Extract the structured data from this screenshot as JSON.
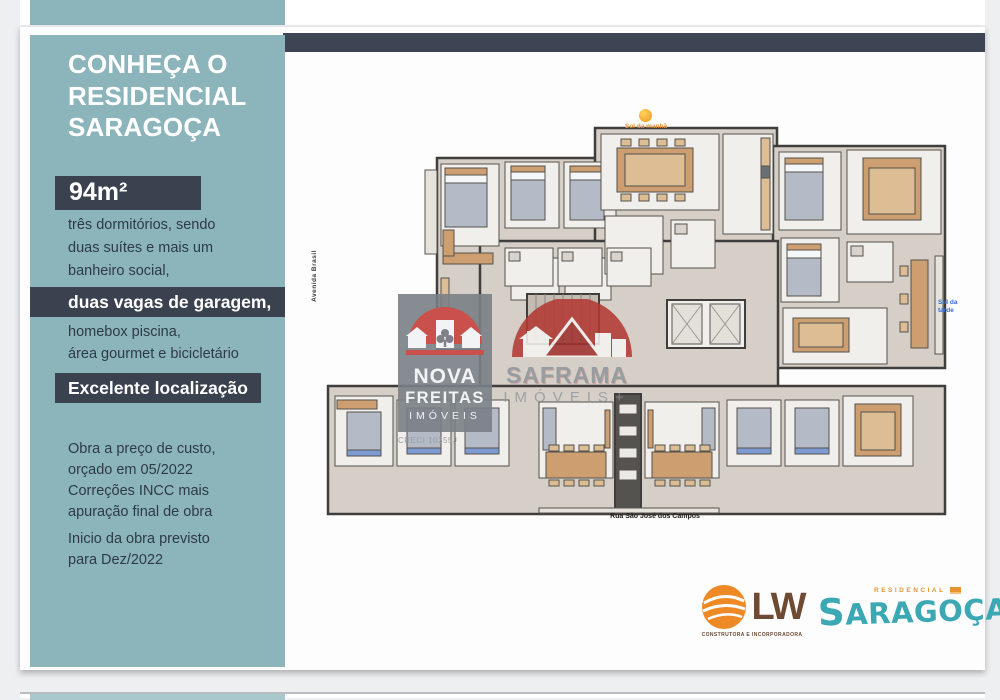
{
  "sidebar": {
    "title_lines": [
      "CONHEÇA O",
      "RESIDENCIAL",
      "SARAGOÇA"
    ],
    "area_badge": "94m²",
    "features_1": [
      "três dormitórios, sendo",
      "duas suítes e mais um",
      "banheiro social,"
    ],
    "highlight_1": "duas vagas de garagem,",
    "features_2": [
      "homebox piscina,",
      "área gourmet e bicicletário"
    ],
    "highlight_2": "Excelente localização",
    "paragraph_1": [
      "Obra a preço de custo,",
      "orçado em 05/2022",
      "Correções INCC mais",
      "apuração final de obra"
    ],
    "paragraph_2": [
      "Inicio da obra previsto",
      "para Dez/2022"
    ]
  },
  "floorplan": {
    "sun_label": "Sol da manhã",
    "afternoon_sun_label": "Sol da tarde",
    "street_left": "Avenida Brasil",
    "street_bottom": "Rua São José dos Campos"
  },
  "watermarks": {
    "nova_freitas": {
      "line1": "NOVA",
      "line2": "FREITAS",
      "line3": "IMÓVEIS",
      "creci": "CRECI 10355J"
    },
    "saframa": {
      "name": "SAFRAMA",
      "subtitle": "IMÓVEIS",
      "plus": "+"
    }
  },
  "logos": {
    "lw": {
      "name": "LW",
      "subtitle": "CONSTRUTORA E INCORPORADORA"
    },
    "saragoca": {
      "kicker": "RESIDENCIAL",
      "name": "SARAGOÇA"
    }
  },
  "colors": {
    "teal_panel": "#8cb5bb",
    "navy": "#3a4250",
    "lw_orange": "#ee8a25",
    "saragoca_teal": "#3ba8b4",
    "logo_red": "#c9504b"
  }
}
